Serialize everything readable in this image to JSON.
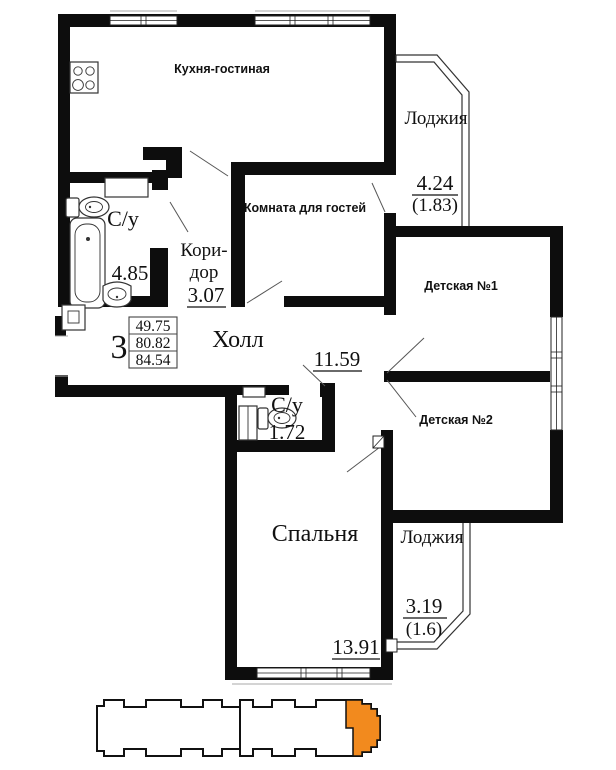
{
  "rooms": {
    "kitchen": {
      "label": "Кухня-гостиная"
    },
    "guest_room": {
      "label": "Комната для гостей"
    },
    "loggia_top": {
      "label": "Лоджия",
      "area": "4.24",
      "area_coeff": "(1.83)"
    },
    "child_room_1": {
      "label": "Детская №1"
    },
    "child_room_2": {
      "label": "Детская №2"
    },
    "bathroom_main": {
      "label": "С/у",
      "area": "4.85"
    },
    "corridor": {
      "label_line_1": "Кори-",
      "label_line_2": "дор",
      "area": "3.07"
    },
    "hall": {
      "label": "Холл",
      "area": "11.59"
    },
    "bathroom_small": {
      "label": "С/у",
      "area": "1.72"
    },
    "bedroom": {
      "label": "Спальня",
      "area": "13.91"
    },
    "loggia_bottom": {
      "label": "Лоджия",
      "area": "3.19",
      "area_coeff": "(1.6)"
    }
  },
  "summary": {
    "room_count": "3",
    "area_living": "49.75",
    "area_without_loggias": "80.82",
    "area_total": "84.54"
  },
  "colors": {
    "walls": "#0d0d0d",
    "footprint_highlight": "#f28a1e"
  }
}
